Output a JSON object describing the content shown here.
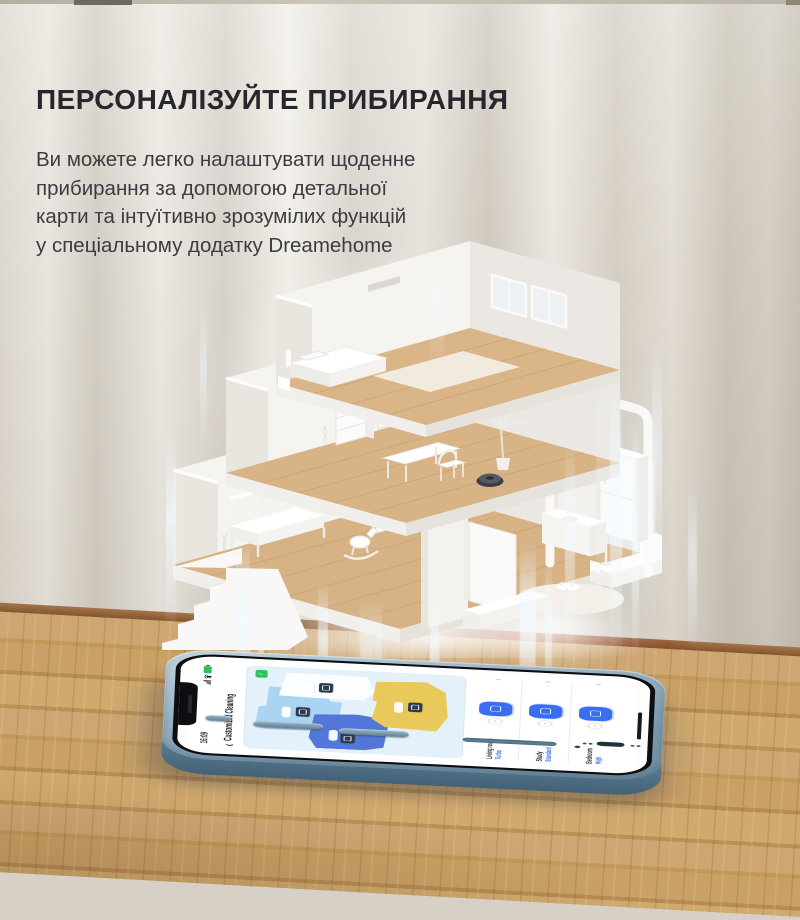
{
  "headline": "ПЕРСОНАЛІЗУЙТЕ ПРИБИРАННЯ",
  "paragraph": {
    "line1": "Ви можете легко налаштувати щоденне",
    "line2": "прибирання за допомогою детальної",
    "line3": "карти та інтуїтивно зрозумілих функцій",
    "line4": "у спеціальному додатку Dreamehome"
  },
  "phone": {
    "status_bar": {
      "time": "16:09"
    },
    "header": {
      "back_icon": "‹",
      "title": "Customized Cleaning"
    },
    "map": {
      "confirm_icon": "✓"
    },
    "rooms_list": [
      {
        "name": "Living room",
        "value": "Turbo"
      },
      {
        "name": "Study",
        "value": "Standard"
      },
      {
        "name": "Bedroom",
        "value": "High"
      }
    ],
    "row_chevron": "›"
  },
  "colors": {
    "accent_blue": "#3a6ef0",
    "room_blue": "#5277d8",
    "room_light_blue": "#aad4f1",
    "room_yellow": "#eac95b",
    "battery_green": "#2ec15a",
    "phone_frame": "#7e9db1",
    "map_bg": "#e4f0fa"
  }
}
